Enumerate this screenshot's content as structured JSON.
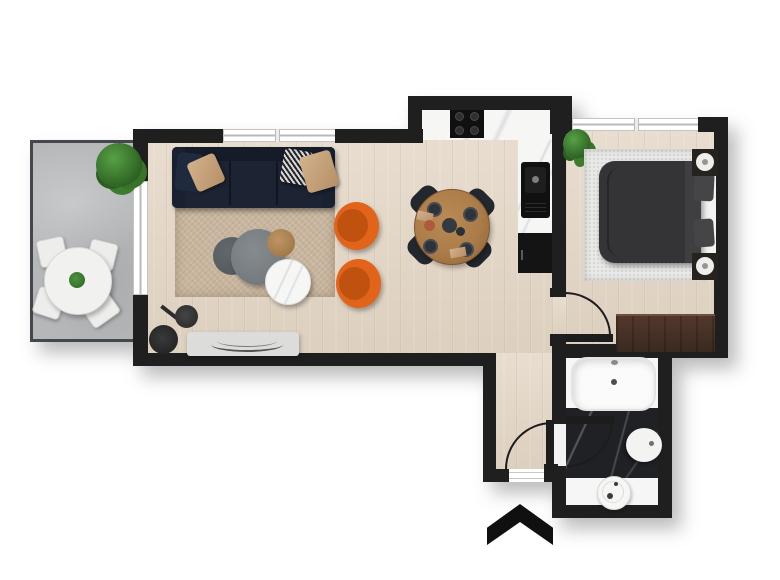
{
  "meta": {
    "type": "floor-plan",
    "view": "top-down architectural rendering",
    "description": "One-bedroom apartment floor plan with open living/dining room, kitchen nook, bedroom, bathroom, entry hall and balcony",
    "visible_text": ""
  },
  "palette": {
    "wall": "#1f1f1f",
    "door": "#1c1c1c",
    "wood": "#e4d8c8",
    "balcony": "#b6b7b9",
    "marble": "#f6f6f5",
    "marble_dark": "#202125",
    "rug_living": "#c8b59e",
    "rug_bedroom": "#e9e9e7",
    "sofa": "#1c2333",
    "orange": "#e2641a",
    "duvet": "#343436",
    "wardrobe": "#45332a",
    "stone": "#6e7378",
    "wood_table": "#ab7c49",
    "plant": "#2d6423",
    "white_fixture": "#f7f7f7"
  },
  "rooms": [
    {
      "id": "living-dining",
      "name": "Living / Dining Room"
    },
    {
      "id": "kitchen",
      "name": "Kitchen Nook"
    },
    {
      "id": "bedroom",
      "name": "Bedroom"
    },
    {
      "id": "bathroom",
      "name": "Bathroom"
    },
    {
      "id": "balcony",
      "name": "Balcony"
    },
    {
      "id": "hallway",
      "name": "Entry Hall"
    }
  ],
  "furniture": {
    "living_dining": [
      "corner-sofa",
      "throw-pillows",
      "shag-rug",
      "stone-coffee-table",
      "stone-side-table",
      "small-wood-table",
      "marble-side-table",
      "orange-armchair-1",
      "orange-armchair-2",
      "floor-lamp",
      "console-table",
      "dining-table",
      "dining-chairs-4",
      "place-settings"
    ],
    "kitchen": [
      "counter-with-cooktop",
      "counter-with-sink",
      "tall-cabinet",
      "potted-plant"
    ],
    "bedroom": [
      "double-bed",
      "duvet",
      "pillows",
      "nightstand-with-lamp-1",
      "nightstand-with-lamp-2",
      "area-rug",
      "wardrobe",
      "potted-plant"
    ],
    "bathroom": [
      "bathtub",
      "wall-basin",
      "toilet"
    ],
    "balcony": [
      "round-table",
      "chairs-4",
      "large-plant",
      "table-centerpiece"
    ],
    "hallway": [
      "front-door",
      "bedroom-door",
      "bathroom-door"
    ]
  },
  "markers": {
    "entrance_arrow": "black chevron pointing up at the front door"
  }
}
